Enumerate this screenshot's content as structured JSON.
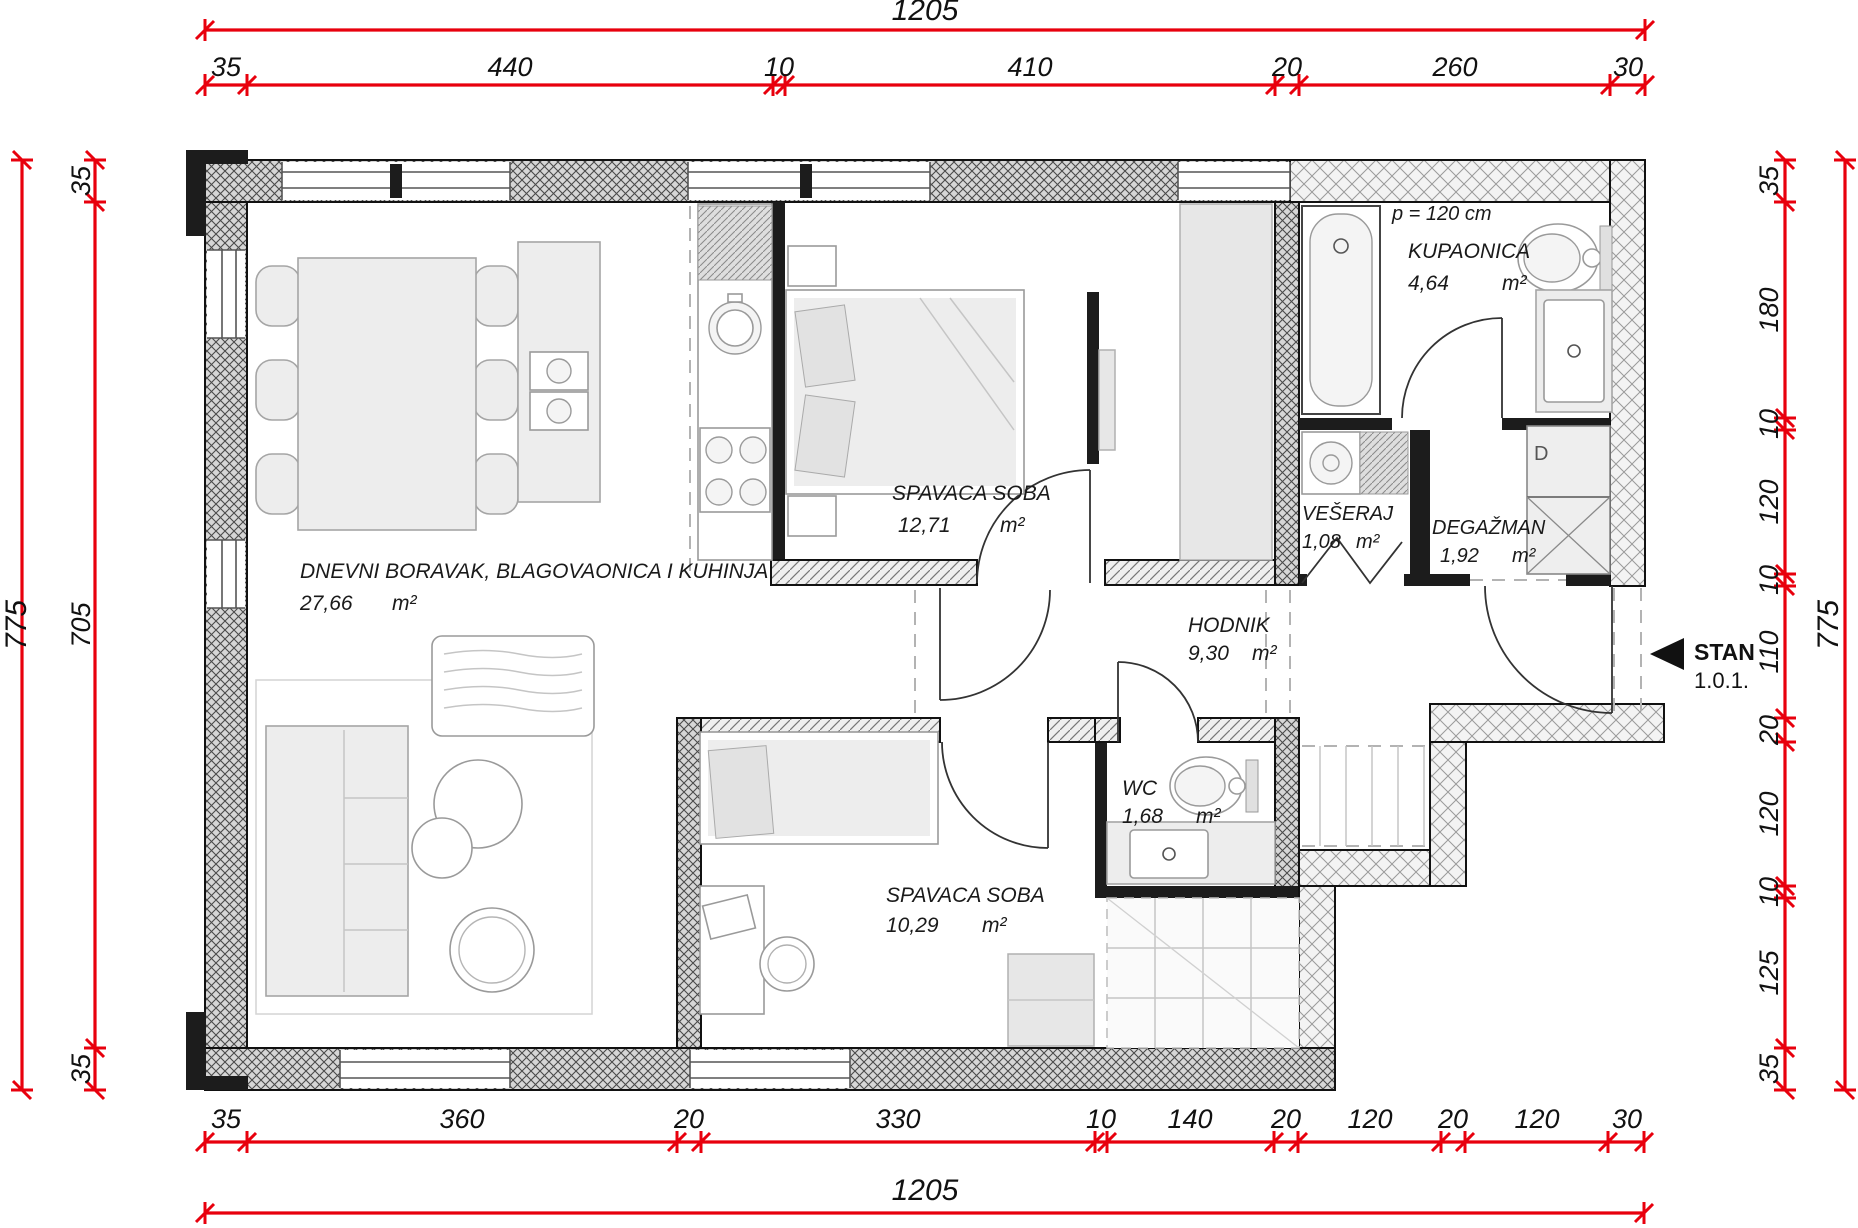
{
  "dimensions": {
    "top": {
      "overall": "1205",
      "segments": [
        "35",
        "440",
        "10",
        "410",
        "20",
        "260",
        "30"
      ]
    },
    "bottom": {
      "overall": "1205",
      "segments": [
        "35",
        "360",
        "20",
        "330",
        "10",
        "140",
        "20",
        "120",
        "20",
        "120",
        "30"
      ]
    },
    "left": {
      "overall": "775",
      "segments": [
        "35",
        "705",
        "35"
      ]
    },
    "right": {
      "overall": "775",
      "segments": [
        "35",
        "180",
        "10",
        "120",
        "10",
        "110",
        "20",
        "120",
        "10",
        "125",
        "35"
      ]
    }
  },
  "rooms": {
    "living": {
      "name": "DNEVNI BORAVAK, BLAGOVAONICA I KUHINJA",
      "area": "27,66",
      "unit": "m²"
    },
    "bedroom1": {
      "name": "SPAVACA SOBA",
      "area": "12,71",
      "unit": "m²"
    },
    "bathroom": {
      "name": "KUPAONICA",
      "area": "4,64",
      "unit": "m²"
    },
    "laundry": {
      "name": "VEŠERAJ",
      "area": "1,08",
      "unit": "m²"
    },
    "storage": {
      "name": "DEGAŽMAN",
      "area": "1,92",
      "unit": "m²"
    },
    "hallway": {
      "name": "HODNIK",
      "area": "9,30",
      "unit": "m²"
    },
    "wc": {
      "name": "WC",
      "area": "1,68",
      "unit": "m²"
    },
    "bedroom2": {
      "name": "SPAVACA SOBA",
      "area": "10,29",
      "unit": "m²"
    }
  },
  "annotations": {
    "parapet": "p = 120 cm",
    "apartment_label": "STAN",
    "apartment_number": "1.0.1.",
    "door_mark": "D"
  },
  "colors": {
    "dimension_red": "#e8000d",
    "wall_black": "#1c1c1c",
    "furniture_gray": "#ededed",
    "text": "#1a1a1a"
  }
}
